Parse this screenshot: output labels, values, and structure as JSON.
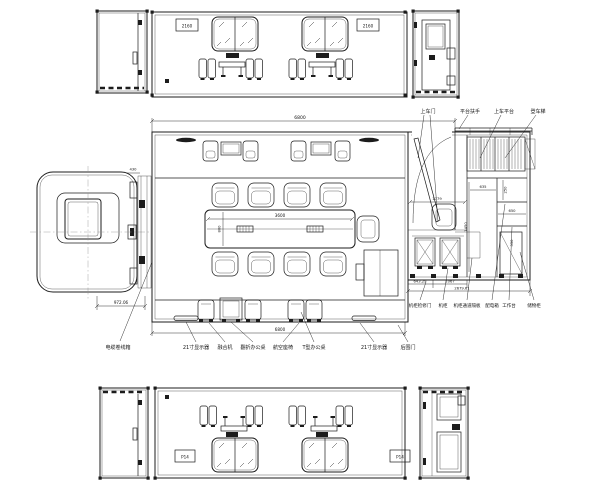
{
  "colors": {
    "line": "#1c1c1c",
    "background": "#ffffff"
  },
  "top_view": {
    "plate_left": "2160",
    "plate_right": "2160"
  },
  "plan": {
    "callouts_top": [
      "上车门",
      "平台扶手",
      "上车平台",
      "登车梯"
    ],
    "callouts_bottom": [
      "电缆卷线箱",
      "21寸显示器",
      "融合机",
      "翻折办公桌",
      "航空座椅",
      "T型办公桌",
      "21寸显示器",
      "后围门"
    ],
    "callouts_right": [
      "机柜检修门",
      "机柜",
      "机柜通道隔板",
      "配电箱",
      "工作台",
      "储物柜"
    ],
    "dims": {
      "overall_top": "6800",
      "overall_bottom": "6800",
      "table_len": "3600",
      "table_w": "800",
      "cab": "972.06",
      "cab_top": "430",
      "door": "1779",
      "vest": "1450",
      "bay_a": "635",
      "bay_b": "250",
      "bay_c": "650",
      "bay_d": "550",
      "rear_a": "643.29",
      "rear_b": "1067",
      "rear_c": "2679.61"
    }
  },
  "bottom_view": {
    "plate_left": "P14",
    "plate_right": "P14"
  }
}
